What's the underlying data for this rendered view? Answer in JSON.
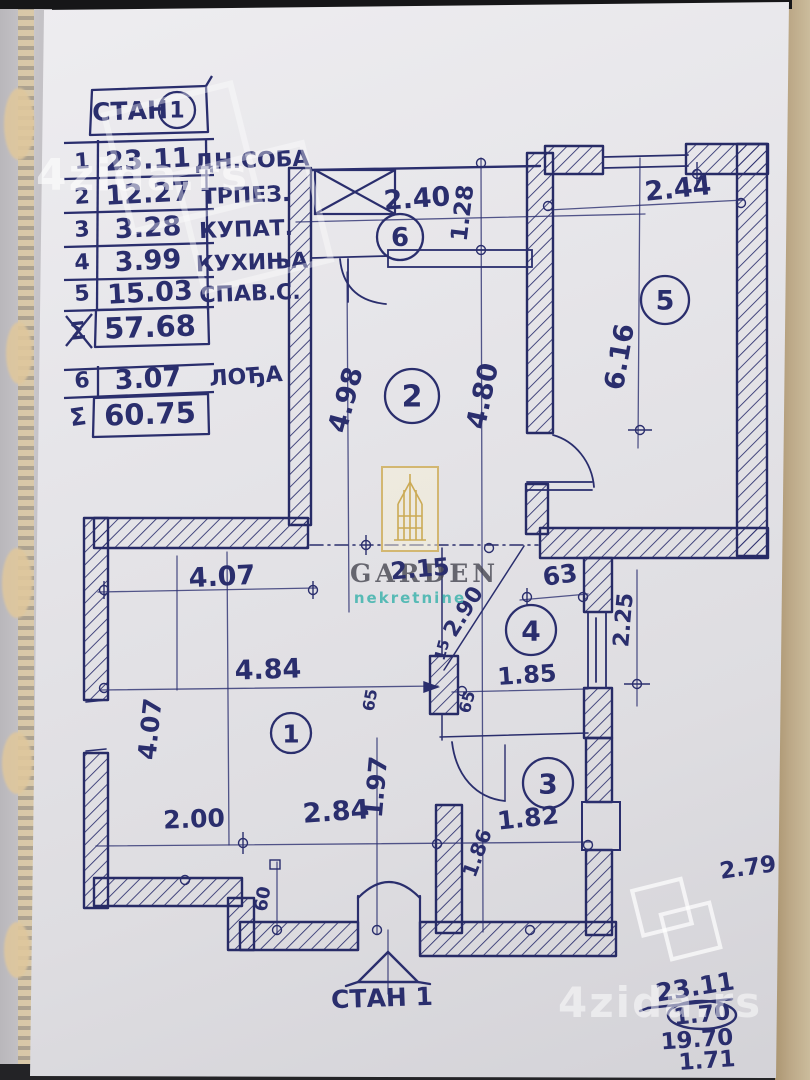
{
  "colors": {
    "ink": "#2a2e6d",
    "paper": "#e6e5e9",
    "logo_gold": "#d2b468",
    "logo_teal": "#42b4ae",
    "wood": "#a8926d",
    "watermark_white": "rgba(255,255,255,0.55)"
  },
  "table": {
    "title": "СТАН",
    "title_number": "1",
    "rows": [
      {
        "num": "1",
        "value": "23.11",
        "label": "ДН.СОБА"
      },
      {
        "num": "2",
        "value": "12.27",
        "label": "ТРПЕЗ."
      },
      {
        "num": "3",
        "value": "3.28",
        "label": "КУПАТ."
      },
      {
        "num": "4",
        "value": "3.99",
        "label": "КУХИЊА"
      },
      {
        "num": "5",
        "value": "15.03",
        "label": "СПАВ.С."
      }
    ],
    "subtotal": {
      "symbol": "Σ",
      "value": "57.68"
    },
    "extra_row": {
      "num": "6",
      "value": "3.07",
      "label": "ЛОЂА"
    },
    "total": {
      "symbol": "Σ",
      "value": "60.75"
    }
  },
  "rooms": [
    {
      "number": "1"
    },
    {
      "number": "2"
    },
    {
      "number": "3"
    },
    {
      "number": "4"
    },
    {
      "number": "5"
    },
    {
      "number": "6"
    }
  ],
  "dims": {
    "d240": "2.40",
    "d128": "1.28",
    "d244": "2.44",
    "d616": "6.16",
    "d498": "4.98",
    "d480": "4.80",
    "d407h": "4.07",
    "d215": "2.15",
    "d63": "63",
    "d290": "2.90",
    "d225": "2.25",
    "d484": "4.84",
    "d185": "1.85",
    "d15": "15",
    "d65a": "65",
    "d65b": "65",
    "d407v": "4.07",
    "d197": "1.97",
    "d200": "2.00",
    "d284": "2.84",
    "d182": "1.82",
    "d186": "1.86",
    "d60": "60",
    "d279": "2.79"
  },
  "annotations": {
    "entrance_label": "СТАН 1",
    "calc": {
      "numerator": "23.11",
      "denominator": "1.70",
      "result": "19.70",
      "extra": "1.71"
    }
  },
  "watermarks": {
    "site": "4zida.rs",
    "agency_name": "GARDEN",
    "agency_subtitle": "nekretnine"
  }
}
